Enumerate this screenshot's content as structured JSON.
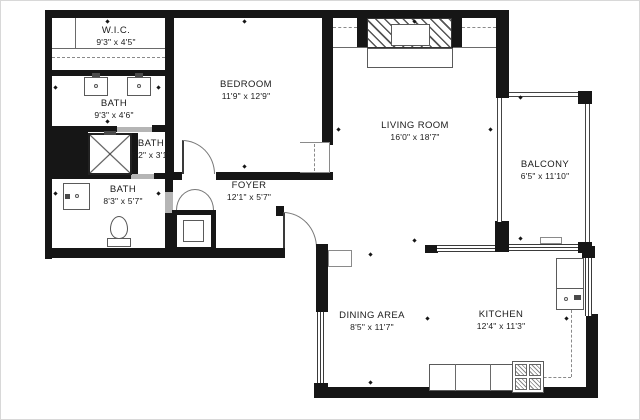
{
  "rooms": [
    {
      "id": "wic",
      "name": "W.I.C.",
      "dims": "9'3\" x 4'5\""
    },
    {
      "id": "bath-double",
      "name": "BATH",
      "dims": "9'3\" x 4'6\""
    },
    {
      "id": "bedroom",
      "name": "BEDROOM",
      "dims": "11'9\" x 12'9\""
    },
    {
      "id": "bath-shower",
      "name": "BATH",
      "dims": "6'2\" x 3'1\""
    },
    {
      "id": "bath-main",
      "name": "BATH",
      "dims": "8'3\" x 5'7\""
    },
    {
      "id": "foyer",
      "name": "FOYER",
      "dims": "12'1\" x 5'7\""
    },
    {
      "id": "living",
      "name": "LIVING ROOM",
      "dims": "16'0\" x 18'7\""
    },
    {
      "id": "balcony",
      "name": "BALCONY",
      "dims": "6'5\" x 11'10\""
    },
    {
      "id": "dining",
      "name": "DINING AREA",
      "dims": "8'5\" x 11'7\""
    },
    {
      "id": "kitchen",
      "name": "KITCHEN",
      "dims": "12'4\" x 11'3\""
    }
  ],
  "colors": {
    "wall": "#161616",
    "line": "#555555",
    "opening": "#b5b5b5",
    "background": "#ffffff"
  }
}
